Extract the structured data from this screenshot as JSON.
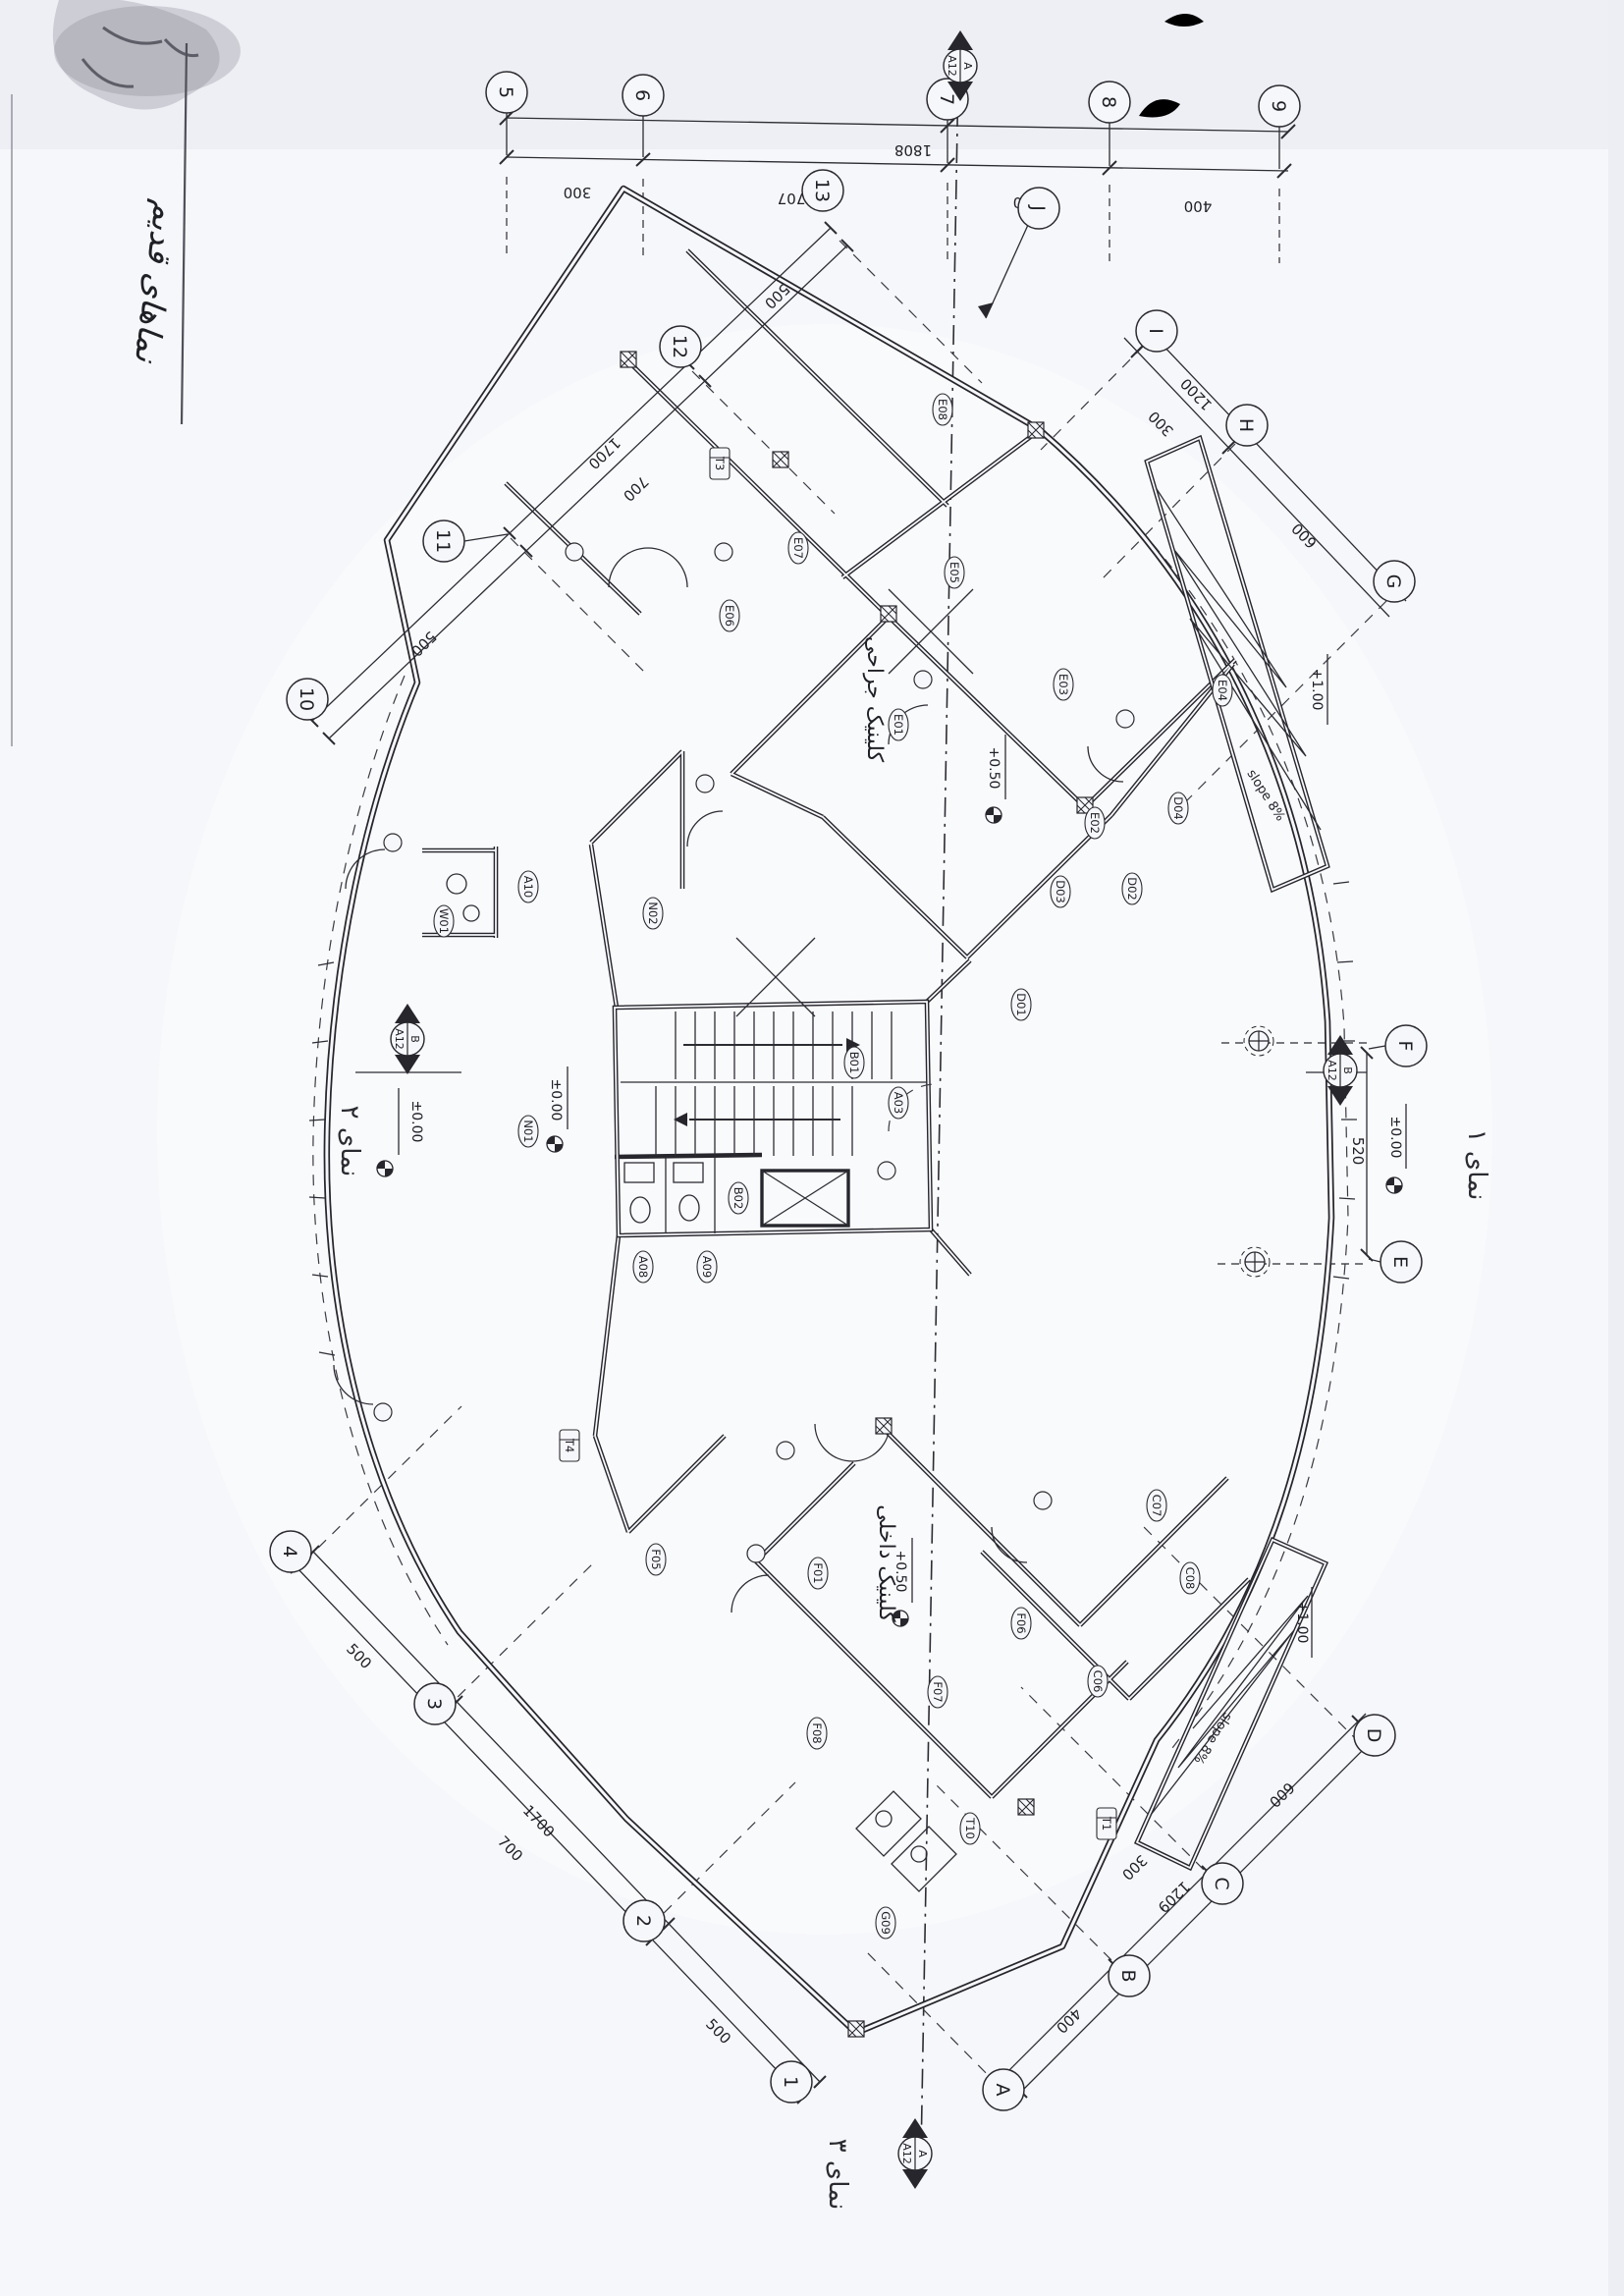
{
  "titles": {
    "note": "نماهای قدیم",
    "surgery": "کلینیک جراحی",
    "internal": "کلینیک داخلی",
    "fa1": "نمای ۱",
    "fa2": "نمای ۲",
    "fa3": "نمای ۳"
  },
  "plan": {
    "axes": {
      "n1": "1",
      "n2": "2",
      "n3": "3",
      "n4": "4",
      "n5": "5",
      "n6": "6",
      "n7": "7",
      "n8": "8",
      "n9": "9",
      "n10": "10",
      "n11": "11",
      "n12": "12",
      "n13": "13",
      "lA": "A",
      "lB": "B",
      "lC": "C",
      "lD": "D",
      "lE": "E",
      "lF": "F",
      "lG": "G",
      "lH": "H",
      "lI": "I",
      "lJ": "J"
    },
    "dims": {
      "total_top": "1808",
      "t1": "300",
      "t2": "707",
      "t3": "400",
      "t4": "400",
      "ul1": "500",
      "ul2": "1700",
      "ul3": "700",
      "ul4": "500",
      "ll1": "500",
      "ll2": "1700",
      "ll3": "700",
      "ll4": "500",
      "ur1": "300",
      "ur2": "1200",
      "ur3": "600",
      "lr1": "600",
      "lr2": "1209",
      "lr3": "300",
      "lr4": "400",
      "rm": "520"
    },
    "levels": {
      "zero": "±0.00",
      "half": "+0.50",
      "one": "+1.00",
      "slope": "slope 8%"
    },
    "section": {
      "a": "A",
      "b": "B",
      "sheet": "A12"
    },
    "codes": {
      "E01": "E01",
      "E02": "E02",
      "E03": "E03",
      "E04": "E04",
      "E05": "E05",
      "E06": "E06",
      "E07": "E07",
      "E08": "E08",
      "D01": "D01",
      "D02": "D02",
      "D03": "D03",
      "D04": "D04",
      "C06": "C06",
      "C07": "C07",
      "C08": "C08",
      "F01": "F01",
      "F05": "F05",
      "F06": "F06",
      "F07": "F07",
      "F08": "F08",
      "N01": "N01",
      "N02": "N02",
      "A03": "A03",
      "A08": "A08",
      "A09": "A09",
      "A10": "A10",
      "W01": "W01",
      "B01": "B01",
      "B02": "B02",
      "T1": "T1",
      "T3": "T3",
      "T4": "T4",
      "T10": "T10",
      "G09": "G09"
    }
  }
}
